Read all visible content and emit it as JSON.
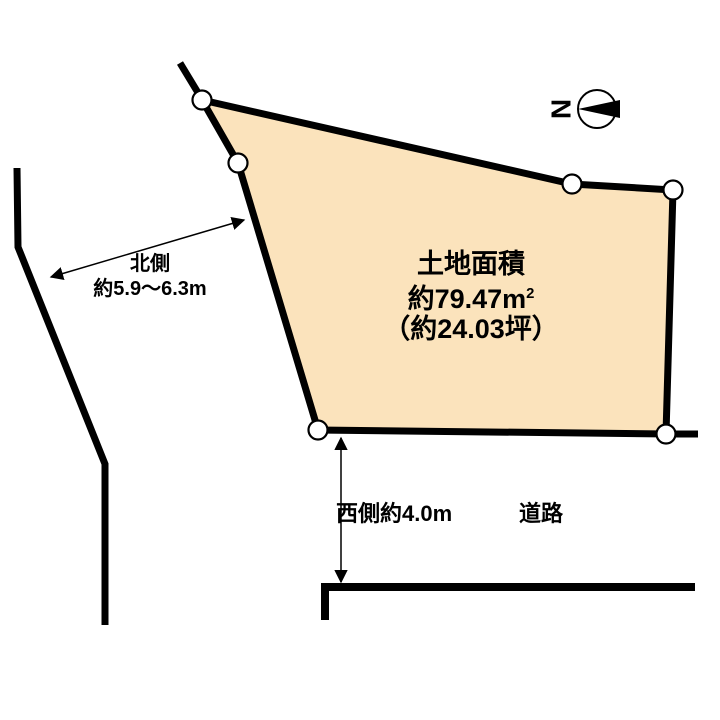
{
  "colors": {
    "parcel_fill": "#FBE3BC",
    "line": "#000000",
    "background": "#FFFFFF"
  },
  "north_indicator": {
    "letter": "N"
  },
  "parcel": {
    "area_title": "土地面積",
    "area_sqm": "約79.47m",
    "area_sqm_sup": "2",
    "area_tsubo": "（約24.03坪）"
  },
  "dimensions": {
    "north_side_label": "北側",
    "north_side_value": "約5.9～6.3m",
    "west_side_value": "西側約4.0m",
    "road_label": "道路"
  }
}
